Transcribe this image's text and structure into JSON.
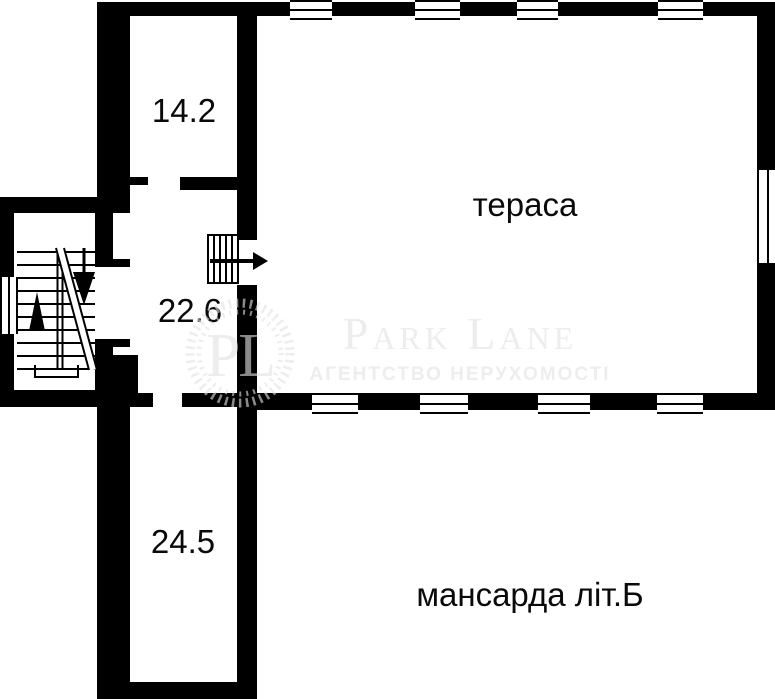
{
  "floorplan": {
    "caption": "мансарда літ.Б",
    "rooms": [
      {
        "name": "top room",
        "area_label": "14.2"
      },
      {
        "name": "terrace",
        "room_label": "тераса"
      },
      {
        "name": "stair hall",
        "area_label": "22.6"
      },
      {
        "name": "corridor",
        "area_label": "24.5"
      }
    ]
  },
  "watermark": {
    "monogram": "PL",
    "brand": "Park Lane",
    "tagline": "АГЕНТСТВО НЕРУХОМОСТІ"
  },
  "colors": {
    "wall": "#000000",
    "background": "#ffffff",
    "watermark": "#e2e2e2"
  }
}
